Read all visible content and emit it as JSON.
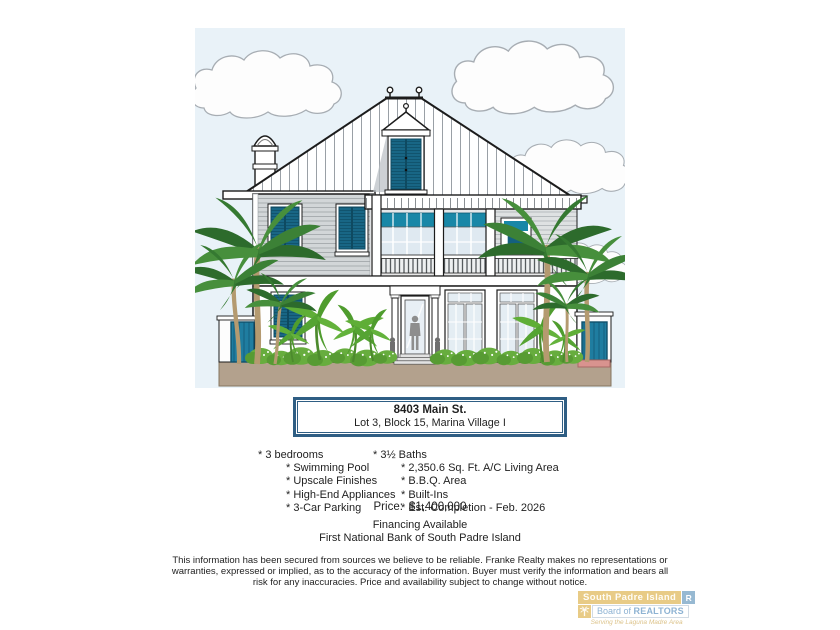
{
  "listing": {
    "address_line1": "8403 Main St.",
    "address_line2": "Lot 3, Block 15, Marina Village I",
    "features_left": [
      {
        "label": "* 3 bedrooms"
      },
      {
        "label": "* Swimming Pool"
      },
      {
        "label": "* Upscale Finishes"
      },
      {
        "label": "* High-End Appliances"
      },
      {
        "label": "* 3-Car Parking"
      }
    ],
    "features_right": [
      {
        "label": "* 3½ Baths"
      },
      {
        "label": "* 2,350.6 Sq. Ft. A/C Living Area"
      },
      {
        "label": "* B.B.Q. Area"
      },
      {
        "label": "* Built-Ins"
      },
      {
        "label": "* Est. Completion - Feb. 2026"
      }
    ],
    "price_label": "Price:",
    "price_value": "$1,400,000",
    "financing_line1": "Financing Available",
    "financing_line2": "First National Bank of South Padre Island"
  },
  "disclaimer": "This information has been secured from sources we believe to be reliable.  Franke Realty makes no representations or warranties, expressed or implied, as to the accuracy of the information.  Buyer must verify the information and bears all risk for any inaccuracies.  Price and availability subject to change without notice.",
  "logo": {
    "region": "South Padre Island",
    "realtor_mark": "R",
    "board_prefix": "Board of",
    "board_strong": "REALTORS",
    "tagline": "Serving the Laguna Madre Area"
  },
  "colors": {
    "shutter_teal": "#17627f",
    "transom_teal": "#1887a7",
    "gate_teal": "#1f7da0",
    "sky_blue": "#e9f2f8",
    "ground_tan": "#b3a18d",
    "address_box_border": "#2f5e84",
    "logo_gold": "#e7c77c",
    "logo_blue": "#8fb4cf",
    "step_pink": "#d9938f"
  }
}
